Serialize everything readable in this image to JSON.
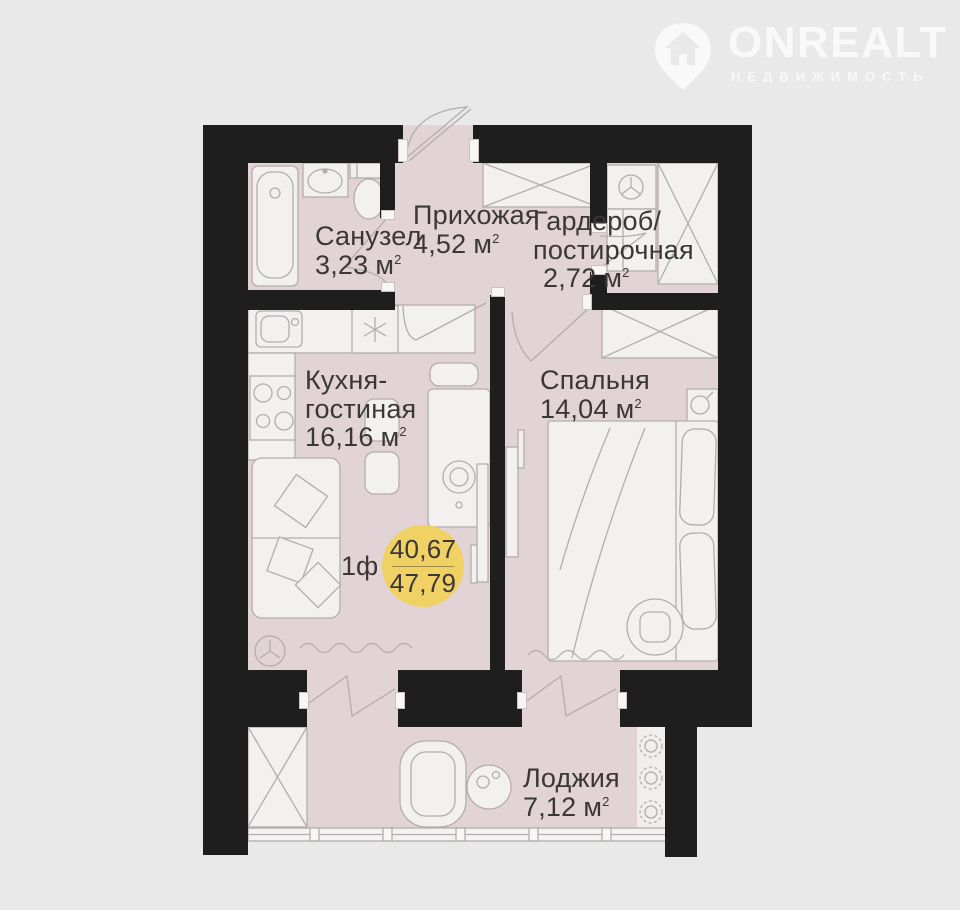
{
  "brand": {
    "wordmark": "ONREALT",
    "tagline": "НЕДВИЖИМОСТЬ"
  },
  "badge": {
    "value_top": "40,67",
    "value_bottom": "47,79",
    "floor_label": "1ф"
  },
  "rooms": {
    "bathroom": {
      "name": "Санузел",
      "area": "3,23"
    },
    "hallway": {
      "name": "Прихожая",
      "area": "4,52"
    },
    "wardrobe": {
      "name_line1": "Гардероб/",
      "name_line2": "постирочная",
      "area": "2,72"
    },
    "kitchen": {
      "name_line1": "Кухня-",
      "name_line2": "гостиная",
      "area": "16,16"
    },
    "bedroom": {
      "name": "Спальня",
      "area": "14,04"
    },
    "loggia": {
      "name": "Лоджия",
      "area": "7,12"
    }
  },
  "units": {
    "area": "м",
    "sup": "2"
  },
  "colors": {
    "background": "#e9e9e9",
    "floor": "#e2d3d6",
    "wall": "#1e1e1e",
    "badge": "#efd164",
    "text": "#3b3739"
  }
}
